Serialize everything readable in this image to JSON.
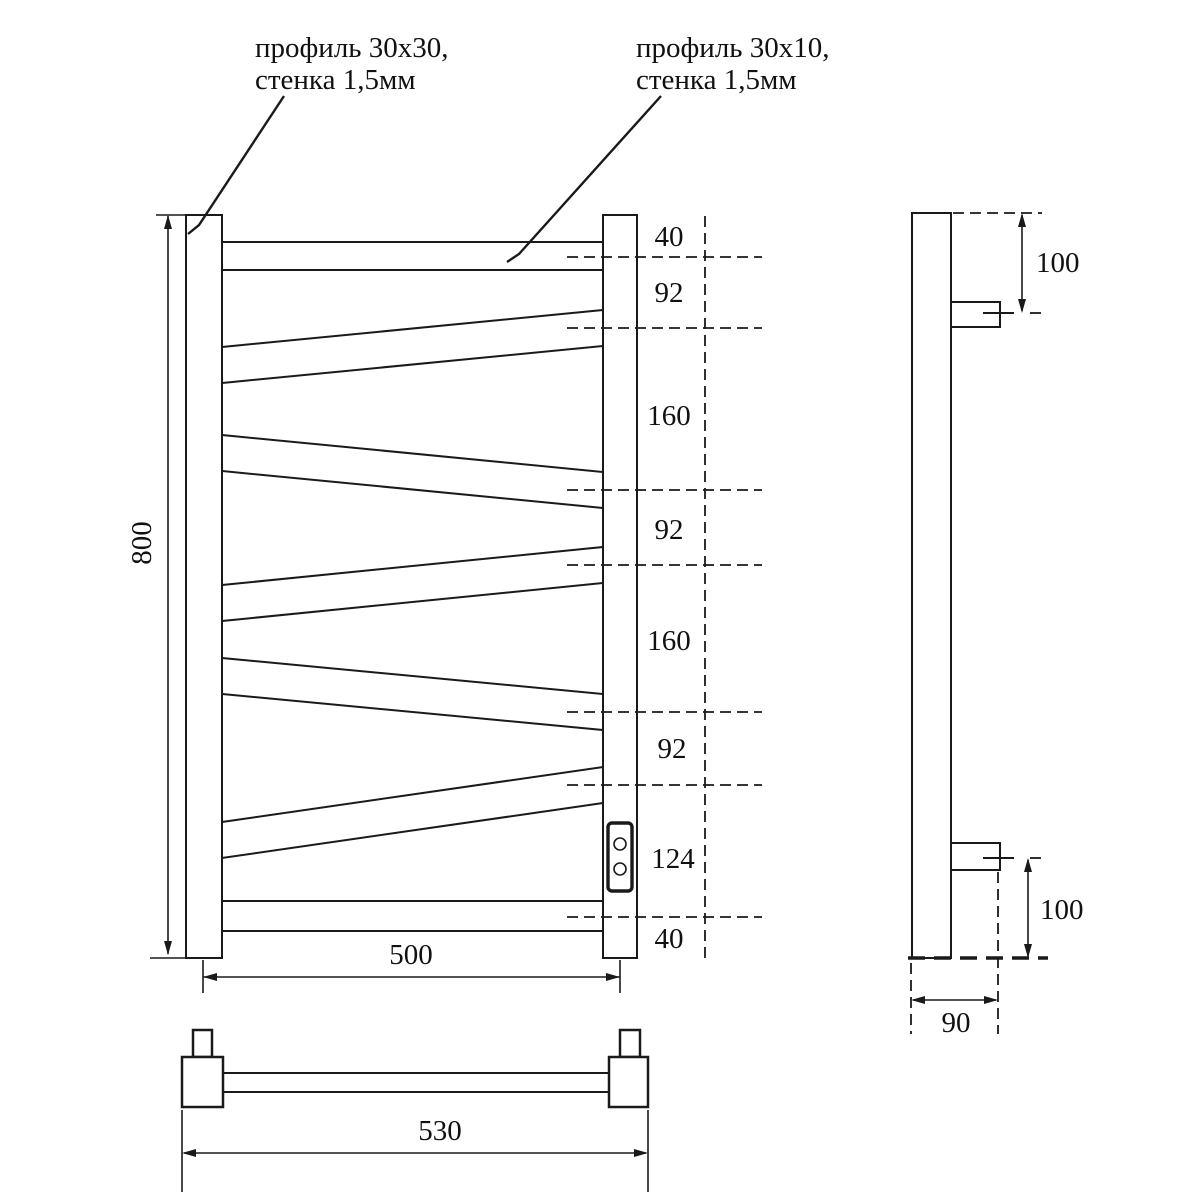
{
  "colors": {
    "line": "#1a1a1a",
    "background": "#ffffff"
  },
  "callouts": {
    "left": {
      "line1": "профиль 30x30,",
      "line2": "стенка 1,5мм"
    },
    "right": {
      "line1": "профиль 30x10,",
      "line2": "стенка 1,5мм"
    }
  },
  "front": {
    "height": "800",
    "width": "500",
    "segments": [
      "40",
      "92",
      "160",
      "92",
      "160",
      "92",
      "124",
      "40"
    ]
  },
  "side": {
    "top_offset": "100",
    "bottom_offset": "100",
    "depth": "90"
  },
  "bottom": {
    "width": "530"
  }
}
